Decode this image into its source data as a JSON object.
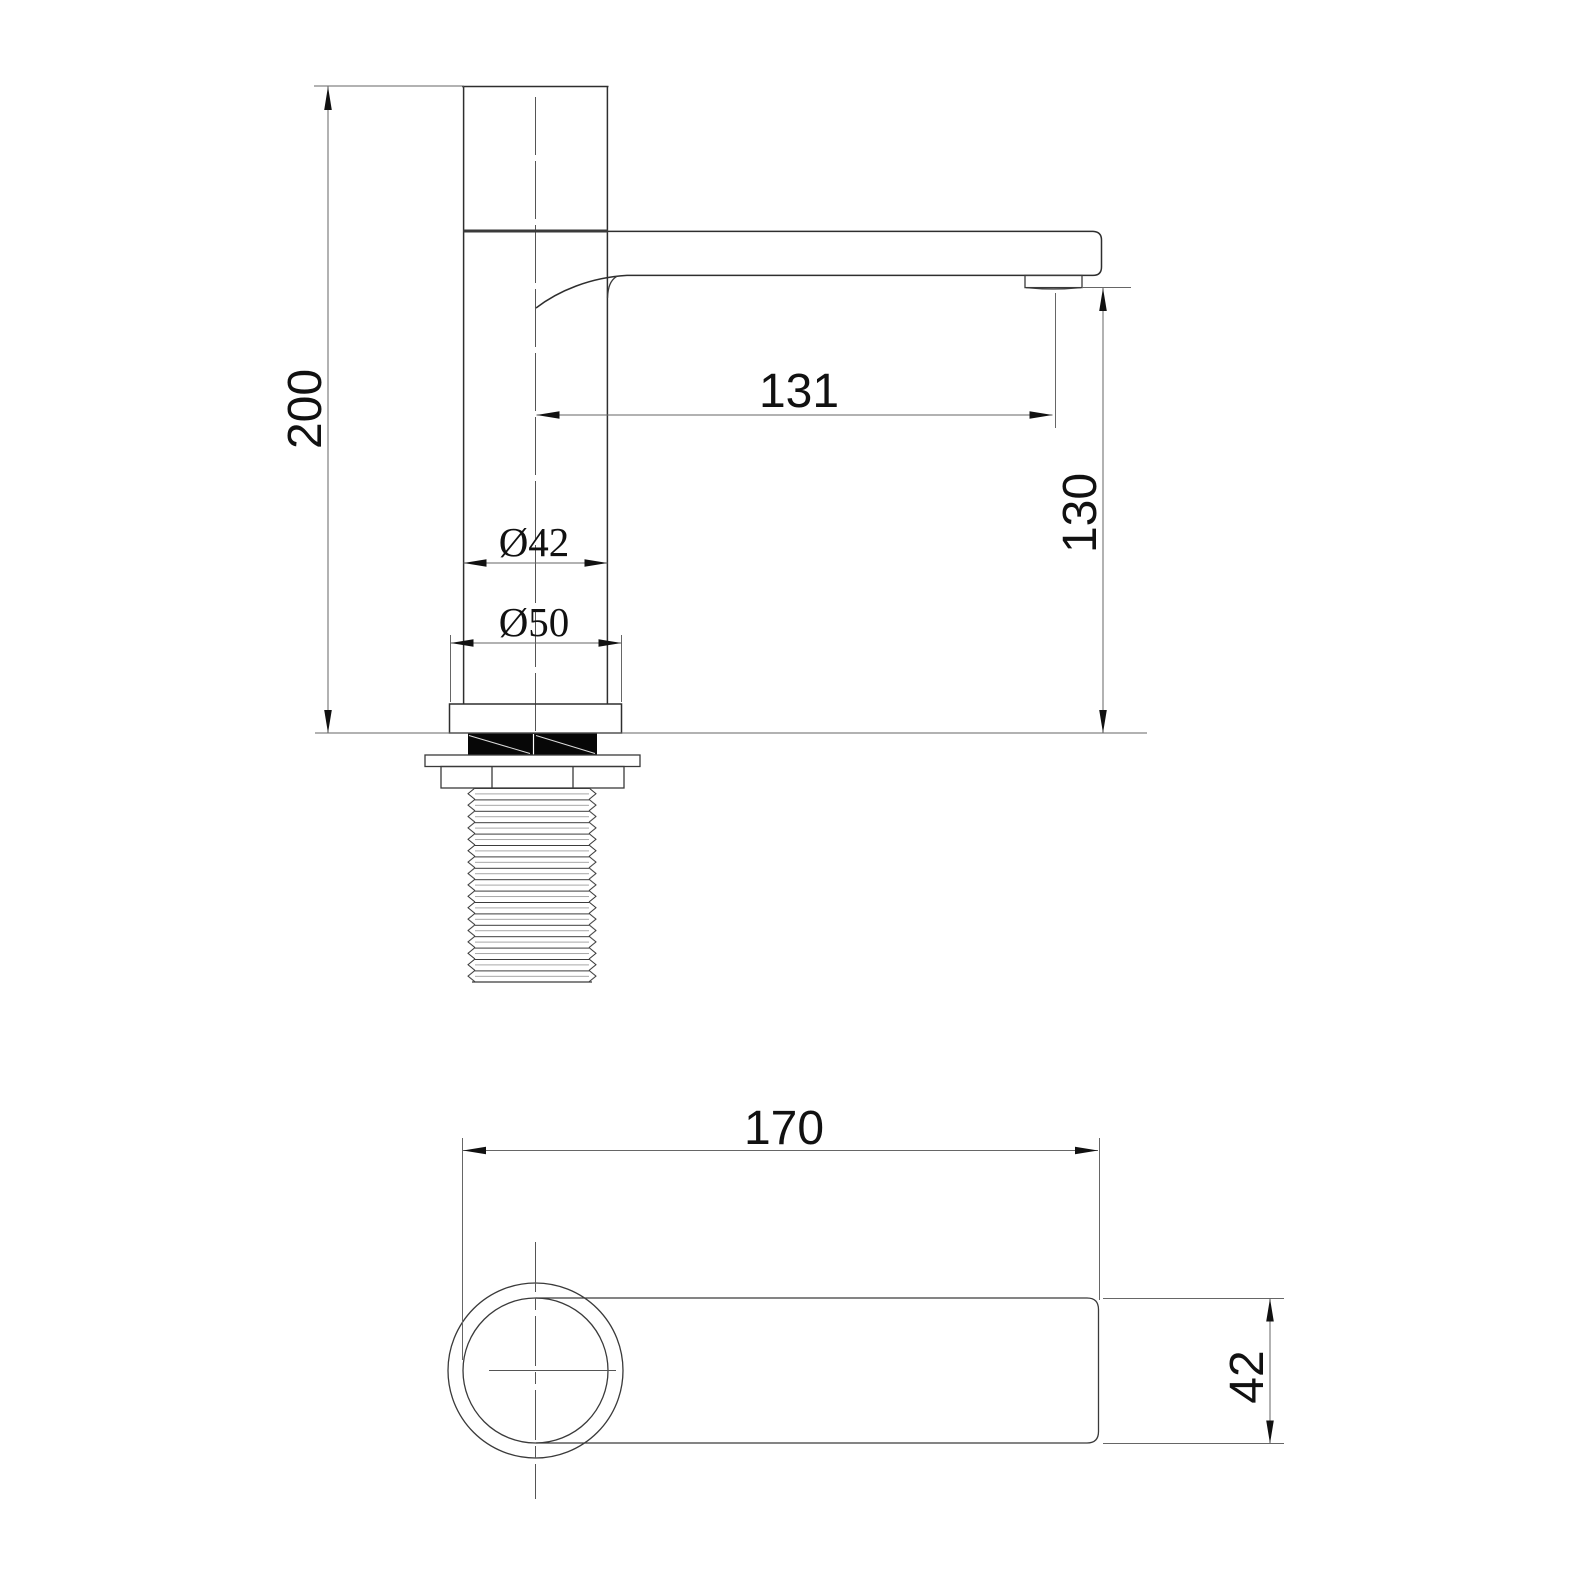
{
  "document": {
    "type": "technical-drawing",
    "subject": "single-hole basin faucet dimensional drawing, side elevation and plan view"
  },
  "colors": {
    "background": "#ffffff",
    "object_line": "#2e2e2e",
    "dimension_line": "#666666",
    "text": "#111111",
    "gasket_fill": "#070707"
  },
  "side_view": {
    "dims": {
      "height": "200",
      "reach": "131",
      "outlet_height": "130",
      "body_diameter": "Ø42",
      "base_diameter": "Ø50"
    }
  },
  "plan_view": {
    "dims": {
      "length": "170",
      "spout_width": "42"
    }
  }
}
